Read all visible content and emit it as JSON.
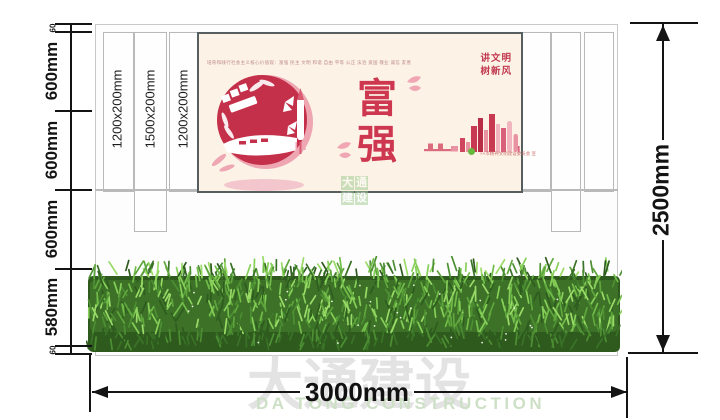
{
  "watermark": {
    "cn": "大通建设",
    "en": "DA TONG CONSTRUCTION",
    "mini": [
      "大",
      "通",
      "建",
      "设"
    ]
  },
  "dimensions": {
    "left_segments": [
      "60",
      "600mm",
      "600mm",
      "600mm",
      "580mm",
      "60"
    ],
    "total_height": "2500mm",
    "total_width": "3000mm"
  },
  "columns": {
    "labels": [
      "1200x200mm",
      "1500x200mm",
      "1200x200mm"
    ]
  },
  "poster": {
    "values_line": "培育和践行社会主义核心价值观：富强 民主 文明 和谐 自由 平等 公正 法治 爱国 敬业 诚信 友善",
    "slogan": [
      "讲文明",
      "树新风"
    ],
    "headline": [
      "富",
      "强"
    ],
    "credit": "××市精神文明建设委员会 宣"
  },
  "colors": {
    "poster_red": "#c93a52",
    "poster_bg": "#fcf2e6",
    "hedge_green": "#4d8f33",
    "watermark_gray": "#e3e3e3",
    "watermark_green": "#cde0c6"
  }
}
